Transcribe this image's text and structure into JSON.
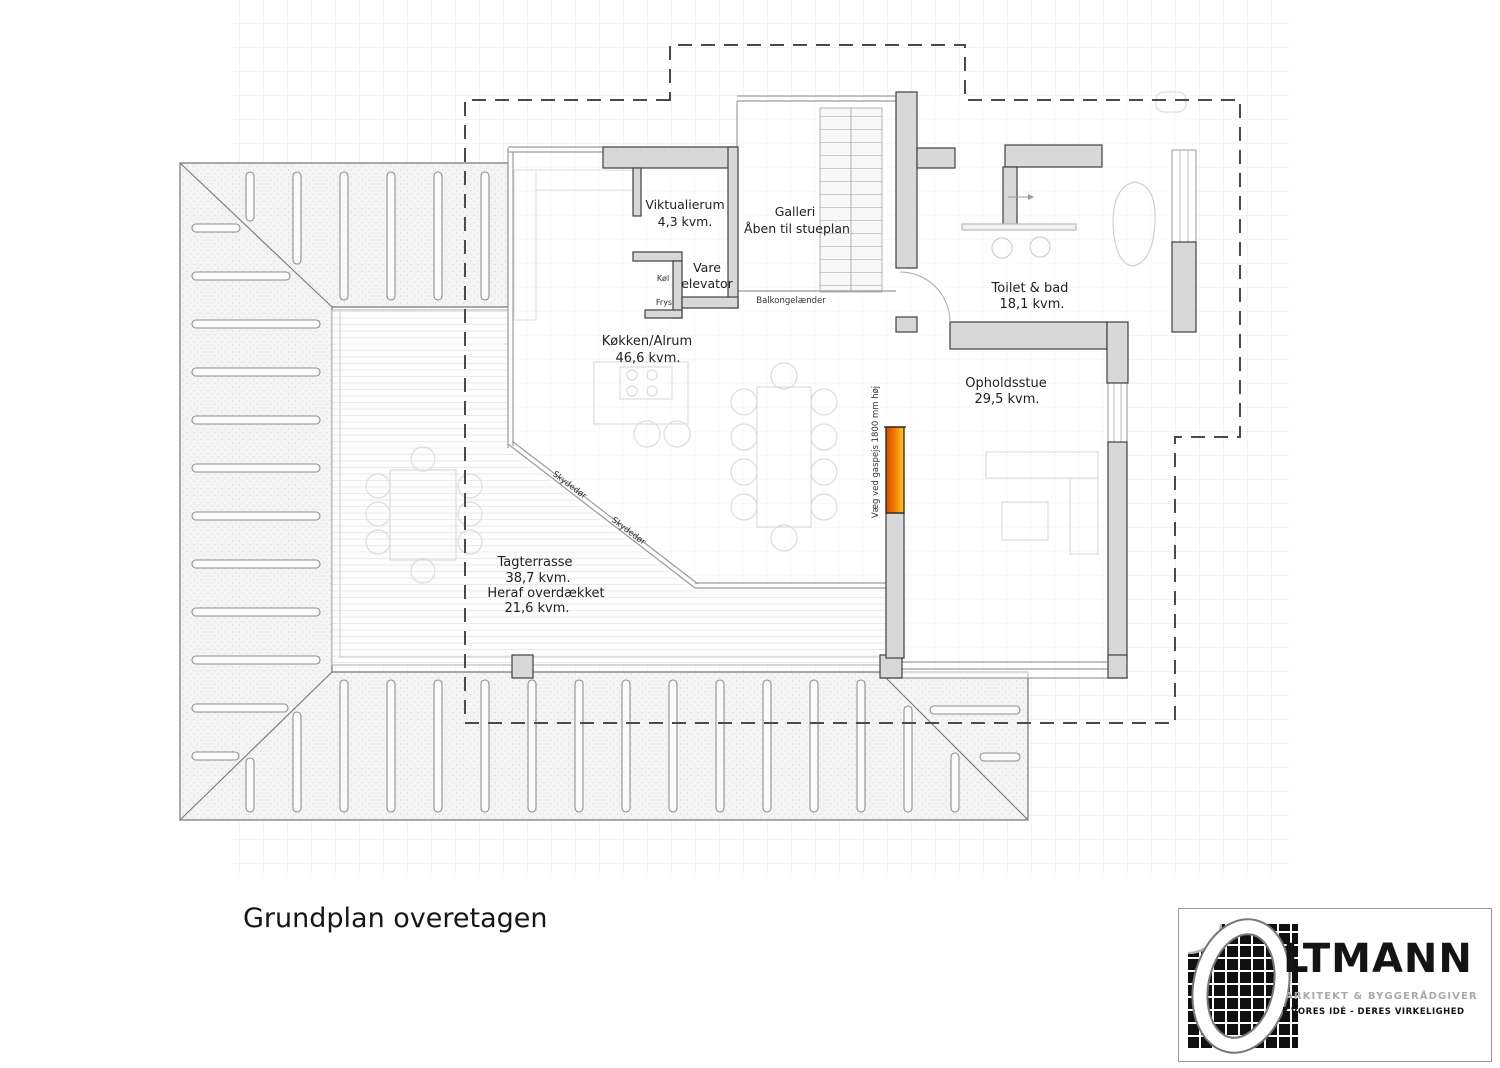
{
  "title": "Grundplan overetagen",
  "rooms": {
    "viktualierum": {
      "name": "Viktualierum",
      "area": "4,3 kvm."
    },
    "galleri": {
      "name": "Galleri",
      "note": "Åben til stueplan"
    },
    "vare_elevator": {
      "line1": "Vare",
      "line2": "elevator"
    },
    "koel": {
      "name": "Køl"
    },
    "frys": {
      "name": "Frys"
    },
    "koekken_alrum": {
      "name": "Køkken/Alrum",
      "area": "46,6 kvm."
    },
    "toilet_bad": {
      "name": "Toilet & bad",
      "area": "18,1 kvm."
    },
    "opholdsstue": {
      "name": "Opholdsstue",
      "area": "29,5 kvm."
    },
    "tagterrasse": {
      "name": "Tagterrasse",
      "area": "38,7 kvm.",
      "note": "Heraf overdækket",
      "note_area": "21,6 kvm."
    }
  },
  "annotations": {
    "balkongelaender": "Balkongelænder",
    "skydedoer_1": "Skydedør",
    "skydedoer_2": "Skydedør",
    "gaspejs_vaeg": "Væg ved gaspejs 1800 mm høj"
  },
  "logo": {
    "initial": "O",
    "name": "LTMANN",
    "subtitle": "ARKITEKT & BYGGERÅDGIVER",
    "tagline": "VORES IDÉ - DERES VIRKELIGHED"
  },
  "colors": {
    "highlight_wall_gradient_start": "#d94a00",
    "highlight_wall_gradient_end": "#ffc81e",
    "wall_fill": "#d8d8d8",
    "wall_stroke": "#3f3f3f",
    "dashed_outline": "#4a4a4a"
  }
}
